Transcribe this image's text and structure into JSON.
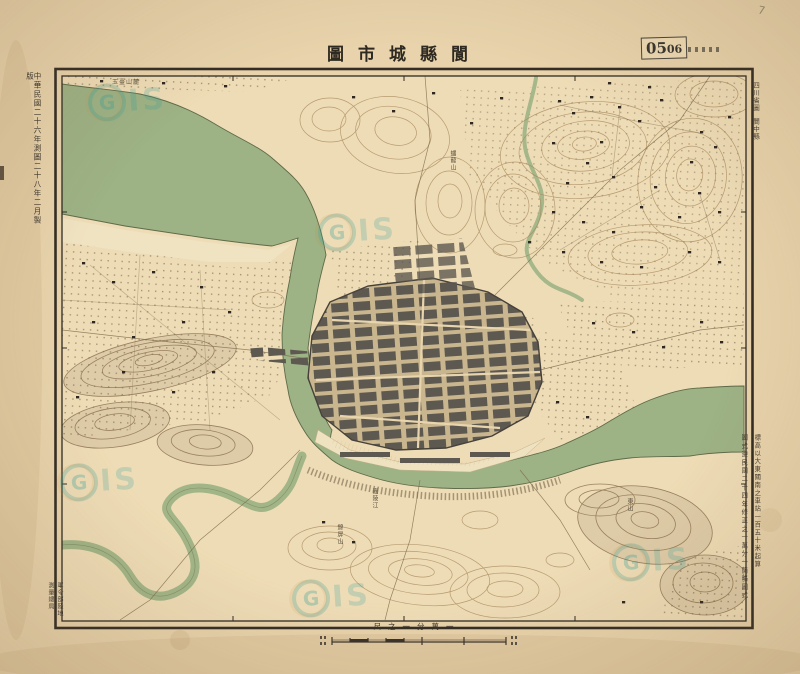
{
  "sheet": {
    "title": "圖市城縣閬",
    "accession_stamp": {
      "large": "05",
      "small": "06"
    },
    "pencil_mark": "7"
  },
  "margins": {
    "left_note": "中華民國二十六年測圖二十八年二月製版",
    "right_top_line1": "四川省圖",
    "right_top_line2": "閬中縣",
    "right_bottom_col1": "標高以大東關南之車站一百五十米起算",
    "right_bottom_col2": "圖式遵民國二十四年修正之一萬分一簡略圖式",
    "imprint_col1": "軍令部陸地",
    "imprint_col2": "測量總局"
  },
  "scale_bar": {
    "label": "尺之一分萬一"
  },
  "watermark": {
    "g": "G",
    "is": "IS"
  },
  "place_labels": [
    {
      "text": "玉臺山麓"
    },
    {
      "text": "蟠龍山"
    },
    {
      "text": "嘉陵江"
    },
    {
      "text": "錦屏山"
    },
    {
      "text": "東山"
    }
  ],
  "colors": {
    "paper": "#e8d3ac",
    "map_base": "#eedcb6",
    "river_green": "#9db285",
    "ink": "#332d23",
    "contour_sepia": "#a4855a",
    "watermark_teal": "#2f9d96"
  }
}
